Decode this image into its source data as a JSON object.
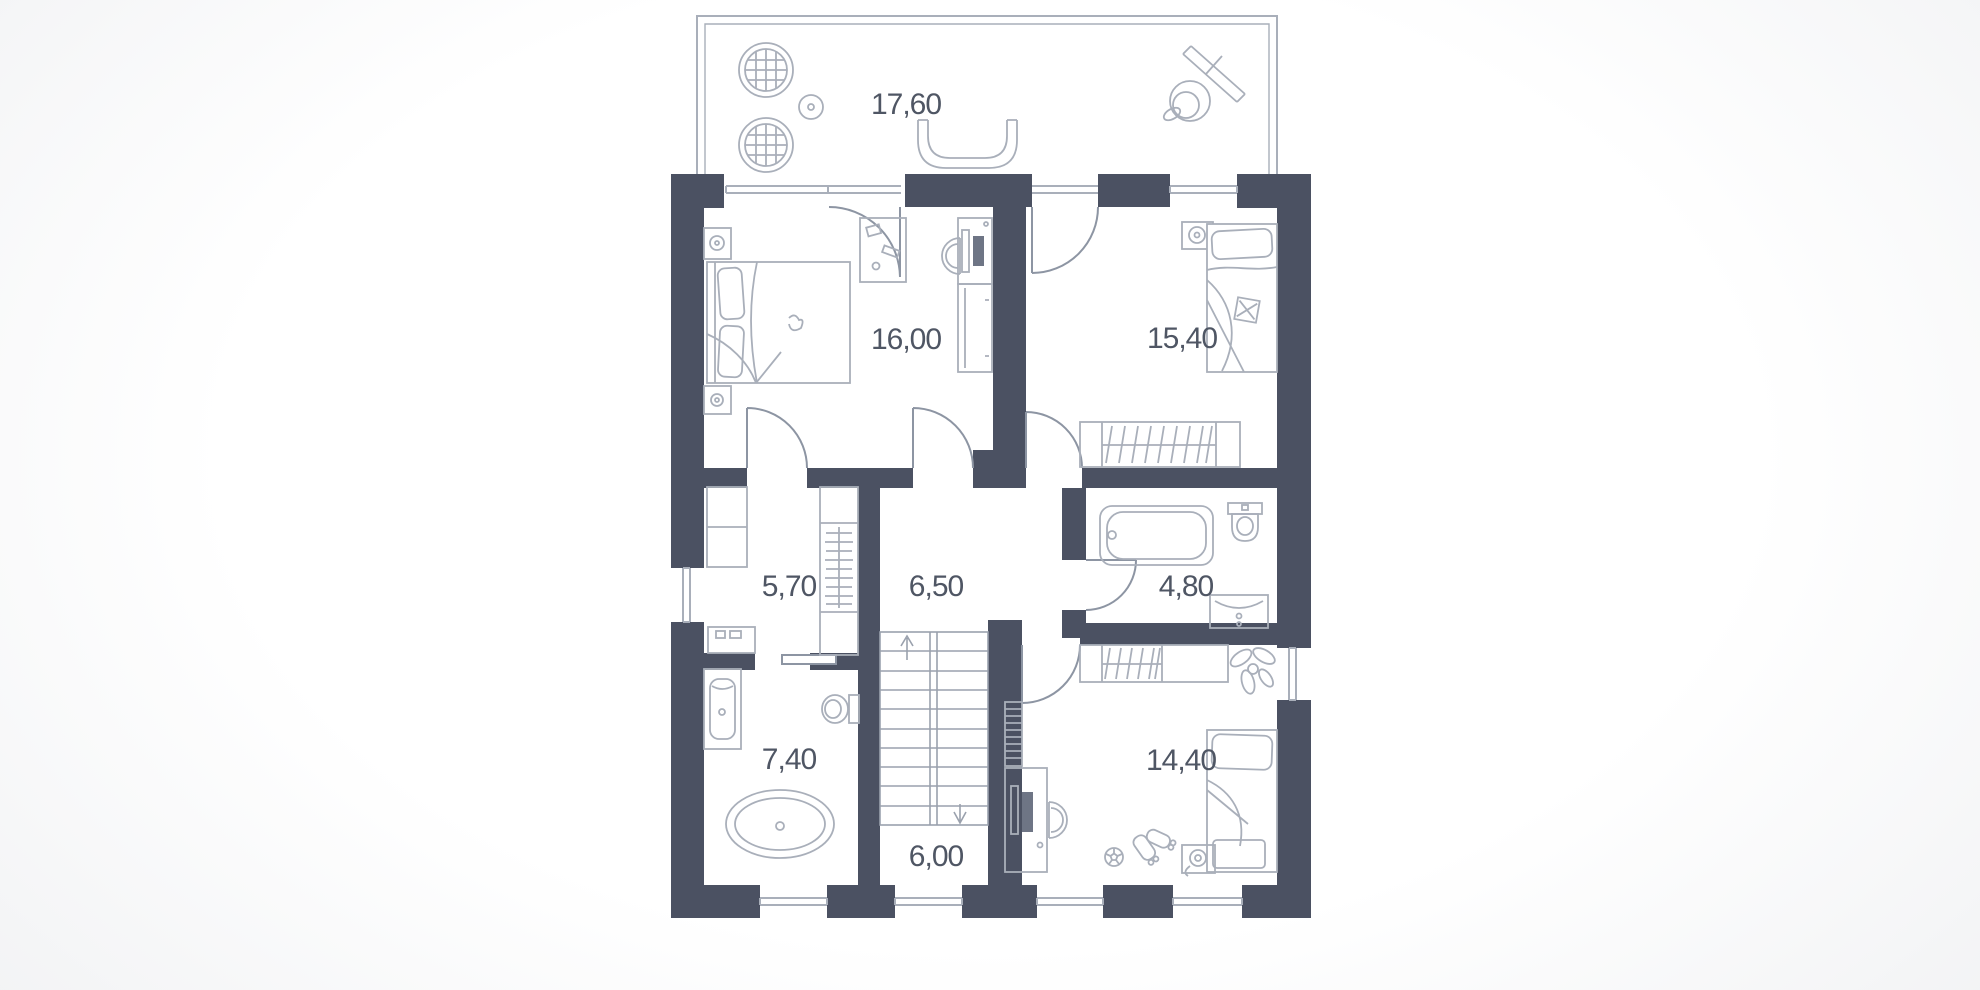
{
  "floorplan": {
    "type": "apartment-floor-plan",
    "units_hint": "area values as printed (decimal comma)",
    "colors": {
      "wall": "#4b5162",
      "furniture_line": "#a9afba",
      "door_line": "#8d95a3",
      "stair_line": "#9aa1ad",
      "label": "#4f5664",
      "floor": "#ffffff",
      "background": "#f1f2f4"
    },
    "rooms": [
      {
        "id": "terrace",
        "area": "17,60",
        "furniture": [
          "hanging-chair",
          "hanging-chair",
          "side-table",
          "curved-bench",
          "drying-rack",
          "ball-chair"
        ]
      },
      {
        "id": "bedroom-main",
        "area": "16,00",
        "furniture": [
          "double-bed",
          "nightstand",
          "nightstand",
          "side-table",
          "desk",
          "desk-chair",
          "dresser"
        ]
      },
      {
        "id": "bedroom-right",
        "area": "15,40",
        "furniture": [
          "single-bed",
          "nightstand",
          "wardrobe"
        ]
      },
      {
        "id": "walk-in-closet",
        "area": "5,70",
        "furniture": [
          "shelf-unit",
          "wardrobe",
          "counter"
        ]
      },
      {
        "id": "hallway",
        "area": "6,50",
        "furniture": []
      },
      {
        "id": "bathroom-small",
        "area": "4,80",
        "furniture": [
          "bathtub",
          "toilet",
          "sink-vanity"
        ]
      },
      {
        "id": "bathroom-main",
        "area": "7,40",
        "furniture": [
          "sink-vanity",
          "toilet",
          "freestanding-bathtub"
        ]
      },
      {
        "id": "stairs",
        "area": "6,00",
        "furniture": [
          "staircase-up",
          "staircase-down"
        ]
      },
      {
        "id": "bedroom-child",
        "area": "14,40",
        "furniture": [
          "wardrobe",
          "plant",
          "single-bed",
          "nightstand",
          "desk",
          "desk-chair",
          "bookshelf",
          "soccer-ball",
          "roller-skates"
        ]
      }
    ]
  }
}
